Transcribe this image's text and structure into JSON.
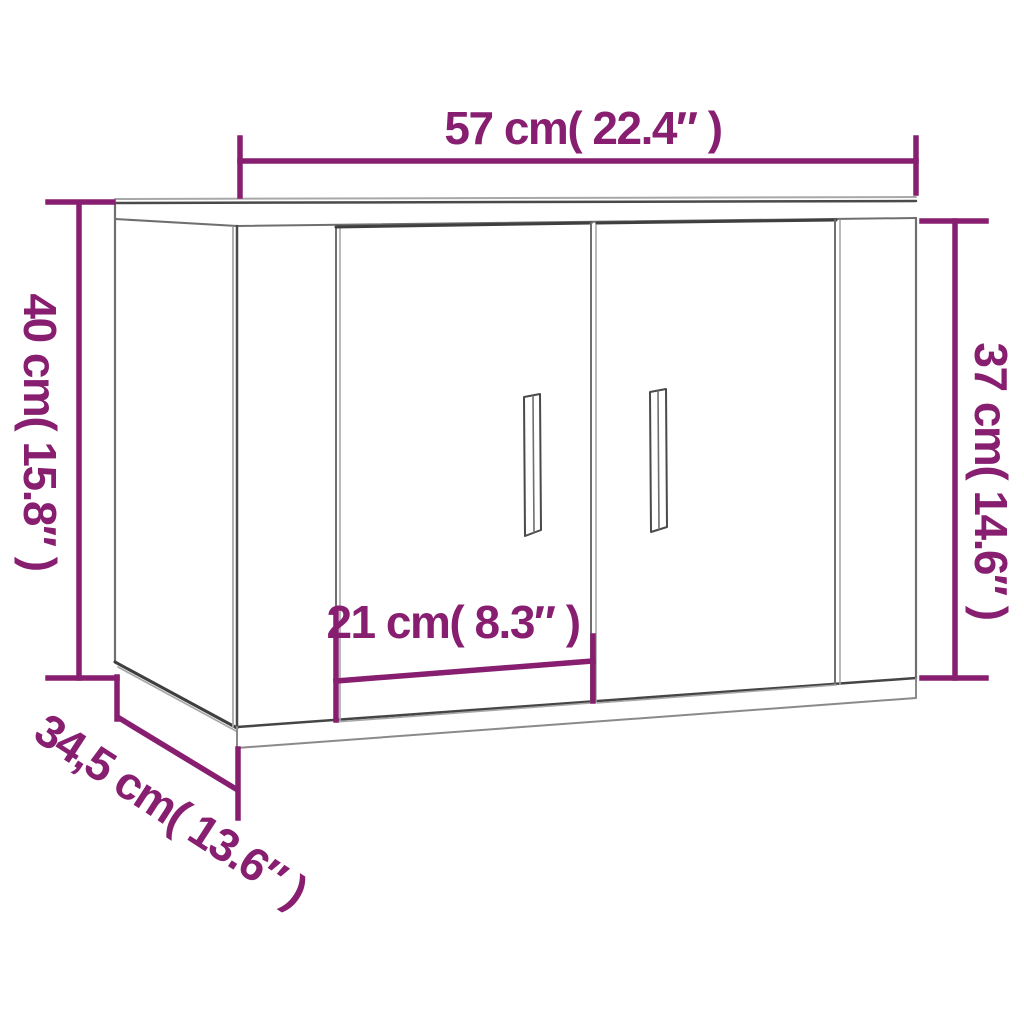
{
  "diagram": {
    "kind": "furniture-dimension-diagram",
    "object": "two-door wall cabinet line drawing",
    "background_color": "#ffffff",
    "dimension_color": "#871e70",
    "line_color_dark": "#3f3f3f",
    "line_color_medium": "#6f6f6f",
    "line_color_light": "#a8a8a8",
    "dimensions": {
      "width": {
        "label": "57 cm( 22.4″ )",
        "value_cm": "57",
        "value_in": "22.4",
        "position": "top"
      },
      "height_left": {
        "label": "40 cm( 15.8″ )",
        "value_cm": "40",
        "value_in": "15.8",
        "position": "left"
      },
      "height_right": {
        "label": "37 cm( 14.6″ )",
        "value_cm": "37",
        "value_in": "14.6",
        "position": "right"
      },
      "depth": {
        "label": "34,5 cm( 13.6″ )",
        "value_cm": "34,5",
        "value_in": "13.6",
        "position": "bottom-left-diagonal"
      },
      "door_width": {
        "label": "21 cm( 8.3″ )",
        "value_cm": "21",
        "value_in": "8.3",
        "position": "inner-left-door"
      }
    }
  }
}
